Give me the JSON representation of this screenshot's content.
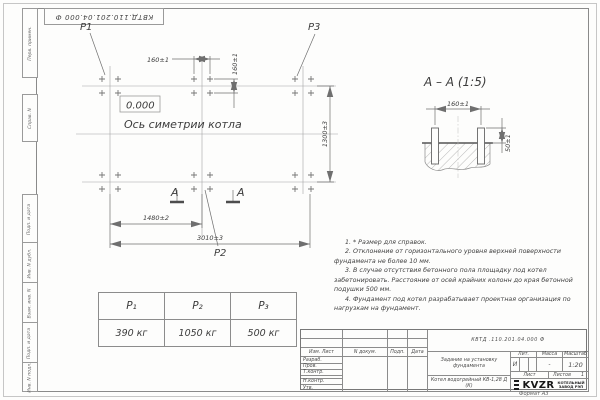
{
  "sheet": {
    "stamp_top": "КВТД.110.201.04.000  Ф",
    "format_label": "Формат А3",
    "side_labels": [
      "Перв. примен.",
      "Справ. N",
      "Подп. и дата",
      "Инв. N дубл.",
      "Взам. инв. N",
      "Подп. и дата",
      "Инв. N подл."
    ]
  },
  "plan": {
    "p1": "P1",
    "p2": "P2",
    "p3": "P3",
    "elevation": "0.000",
    "axis_label": "Ось симетрии котла",
    "dim_bolt_h": "160±1",
    "dim_bolt_v": "160±1",
    "dim_width": "1300±3",
    "dim_half_length": "1480±2",
    "dim_length": "3010±3",
    "section_letter_left": "А",
    "section_letter_right": "А"
  },
  "section_view": {
    "title": "А – А (1:5)",
    "dim_spacing": "160±1",
    "dim_height": "50±1"
  },
  "notes": {
    "items": [
      "1. * Размер для справок.",
      "2. Отклонение от горизонтального уровня верхней поверхности фундамента не более 10 мм.",
      "3. В случае отсутствия бетонного пола площадку под котел забетонировать. Расстояние от осей крайних колонн до края бетонной подушки 500 мм.",
      "4. Фундамент под котел разрабатывает проектная организация по нагрузкам на фундамент."
    ]
  },
  "load_table": {
    "headers": [
      "P₁",
      "P₂",
      "P₃"
    ],
    "values": [
      "390 кг",
      "1050 кг",
      "500 кг"
    ]
  },
  "title_block": {
    "doc_number": "КВТД .110.201.04.000  Ф",
    "doc_title": "Задание на установку фундамента",
    "product": "Котел водогрейный КВ-1,28 Д (К)",
    "col_headers": [
      "Изм. Лист",
      "N докум.",
      "Подп.",
      "Дата"
    ],
    "row_labels": [
      "Разраб.",
      "Пров.",
      "Т.контр.",
      "",
      "Н.контр.",
      "Утв."
    ],
    "lit_label": "Лит.",
    "mass_label": "Масса",
    "scale_label": "Масштаб",
    "lit_value": "И",
    "mass_value": "-",
    "scale_value": "1:20",
    "sheet_label": "Лист",
    "sheets_label": "Листов",
    "sheets_value": "1",
    "logo_text": "KVZR",
    "logo_caption": "КОТЕЛЬНЫЙ ЗАВОД РЭП"
  }
}
